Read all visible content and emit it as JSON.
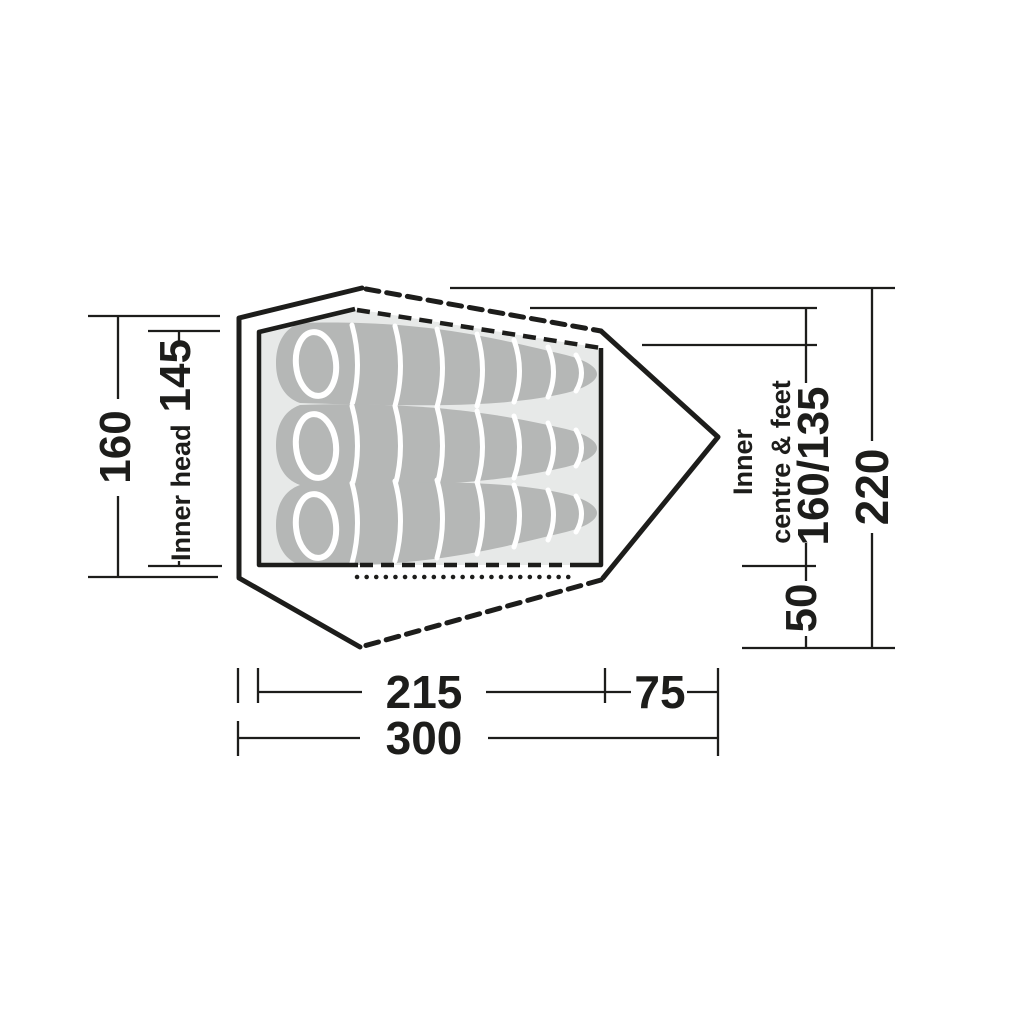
{
  "diagram": {
    "description_colors": {
      "line": "#1d1d1b",
      "inner_tent_fill": "#e7e9e8",
      "sleeping_bag_fill": "#b5b7b6",
      "separator": "#ffffff",
      "background": "#ffffff"
    },
    "left": {
      "outer_value": "160",
      "inner_label": "Inner head",
      "inner_value": "145"
    },
    "right": {
      "inner_label_line1": "Inner",
      "inner_label_line2": "centre & feet",
      "inner_value": "160/135",
      "front_value": "50",
      "overall_value": "220"
    },
    "bottom": {
      "inner_value": "215",
      "front_value": "75",
      "overall_value": "300"
    },
    "sleeping_bag_count": "3"
  }
}
